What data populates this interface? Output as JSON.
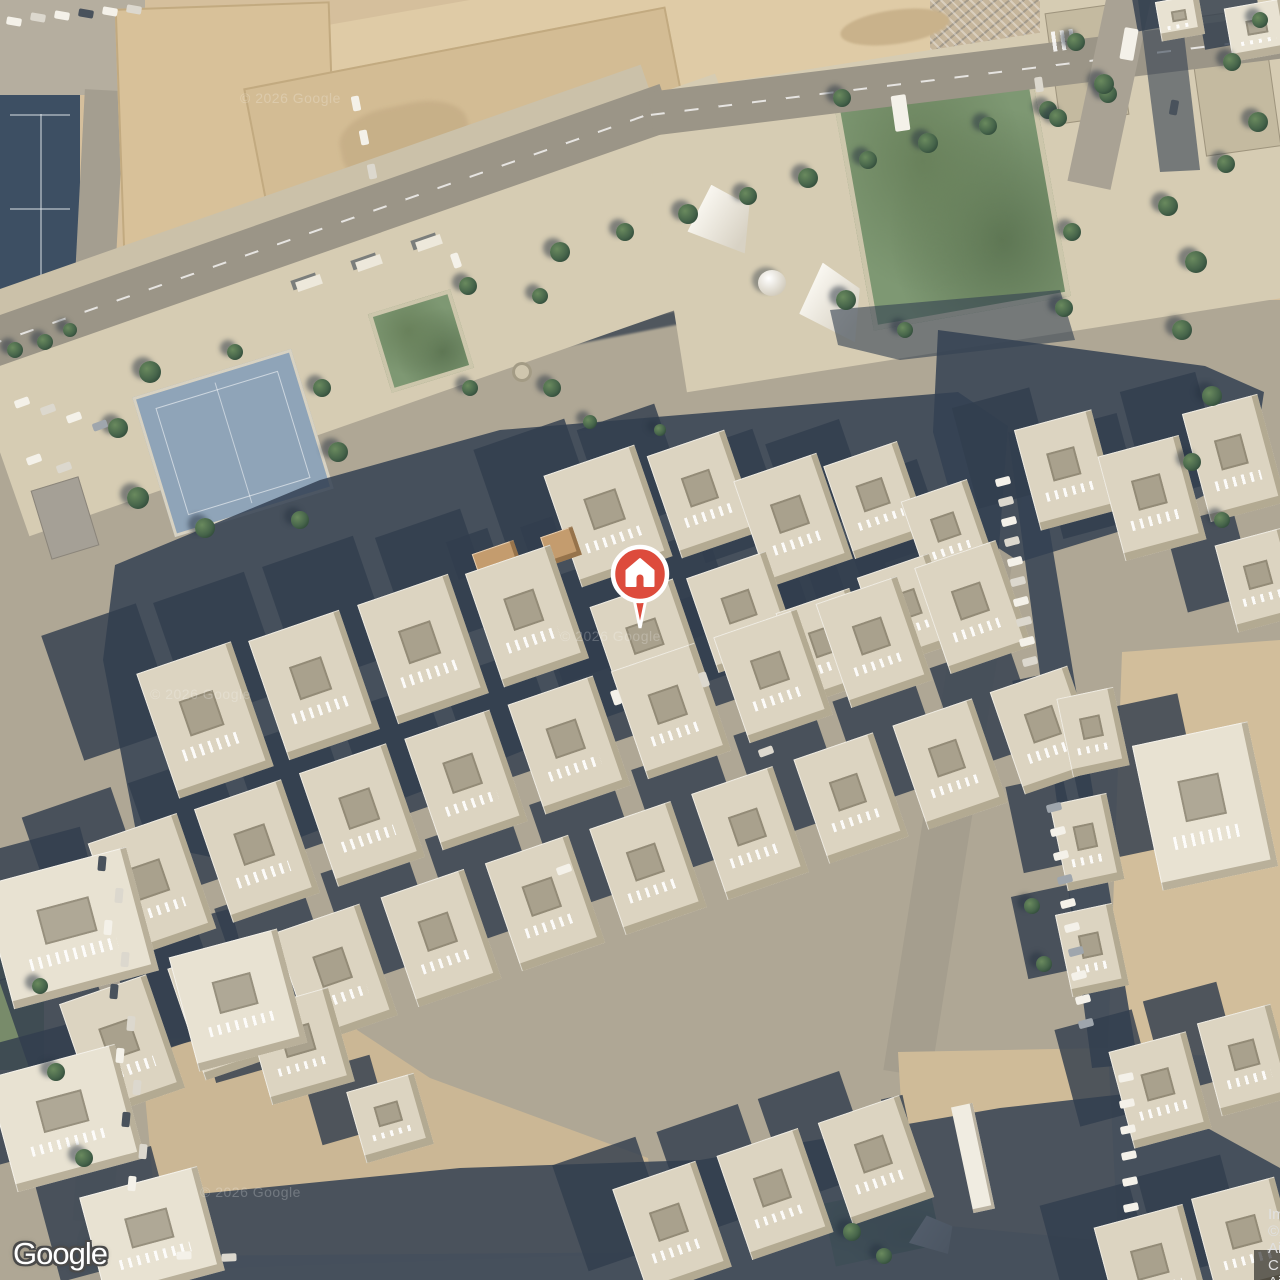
{
  "map": {
    "provider_logo": "Google",
    "attribution": "Imagery ©2026 Airbus, CNES / Airbus, Maxar Technologies",
    "watermark": "© 2026 Google",
    "marker": {
      "type": "saved-place-pin",
      "icon": "home-icon",
      "color": "#DD4B3C"
    },
    "view": "satellite"
  },
  "palette": {
    "sand": "#D5BF9C",
    "sand_light": "#DFCBA6",
    "mound": "#C9B28B",
    "clutter": "#C6B69C",
    "dirt": "#CBB795",
    "paving": "#D6CCB3",
    "road": "#9B9587",
    "street": "#AFA795",
    "building": "#DCD4C1",
    "building_light": "#E8E2D2",
    "facade": "#BFB49C",
    "shadow": "#36455A",
    "field_navy": "#3D4F63",
    "lawn": "#7E9873",
    "lawn_dark": "#6A855F",
    "tree": "#4C6A4B",
    "court_blue": "#8FA4B8",
    "court_gray": "#A5A096",
    "wall": "#C2AA80",
    "pin_red": "#DD4B3C",
    "attr_bg": "rgba(0,0,0,0.55)",
    "attr_text": "#E0E0E0"
  }
}
